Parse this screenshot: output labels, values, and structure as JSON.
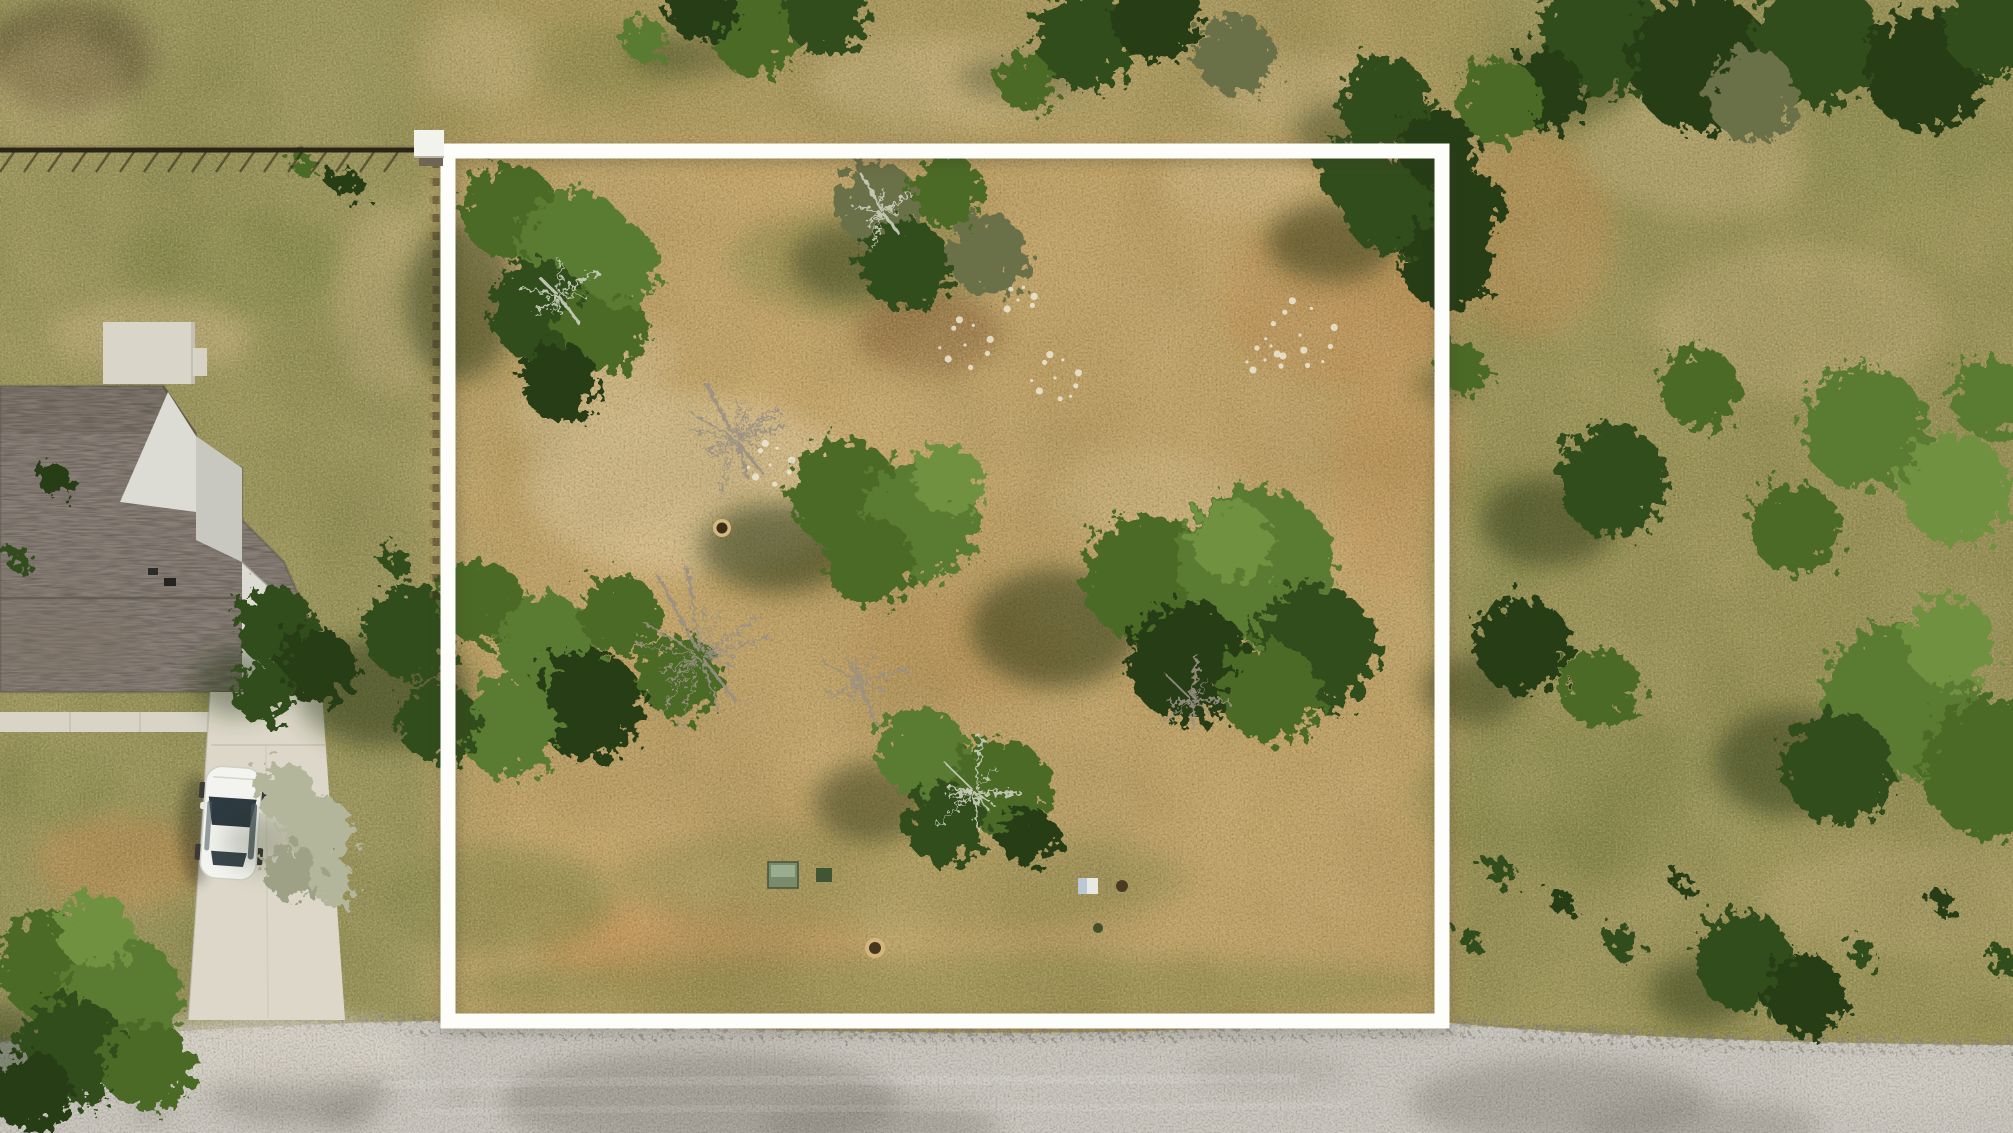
{
  "meta": {
    "kind": "aerial-drone-photo",
    "subject": "vacant residential lot outlined with a white property boundary, house with driveway and car at left, road along bottom",
    "width": 2013,
    "height": 1133
  },
  "colors": {
    "base": "#b09a5f",
    "zone_left": "#8e9055",
    "zone_right": "#8c8d50",
    "zone_top": "#a89759",
    "zone_lot": "#c9a667",
    "road": "#c9c6c0",
    "gravel": "#8a8375",
    "stain_dark": "#827e76",
    "stain_light": "#dad6cc",
    "driveway": "#dcd7c8",
    "sidewalk": "#d8d4c6",
    "patio": "#d9d5c9",
    "roof": "#8a8178",
    "roof_dark": "#7e756c",
    "wall": "#c8c8c1",
    "wall_lit": "#dcdcd4",
    "car": "#f3f3ef",
    "glass": "#2e3a42",
    "glass2": "#39454d",
    "dish": "#eaeae5",
    "fence": "#2b2516",
    "boundary": "#fdfdfa",
    "shadow": "#1f2e11",
    "tm": "#4c6b28",
    "tm2": "#5a7c31",
    "td": "#334d1c",
    "td2": "#273d15",
    "tl": "#6f9240",
    "to": "#6b6f46",
    "dry": "#b4b69c",
    "dry2": "#9fa187",
    "branch": "#9b9184",
    "branch_light": "#ccd0bf",
    "rock": "#ece7d6",
    "dirt_sand": "#d9bf8e",
    "dirt_orange": "#c28b4e",
    "dirt_brown": "#8a5f35",
    "grass_green": "#798140",
    "scrub": "#5d5330",
    "mottle_dark": "#6b6b3a",
    "mottle_light": "#e8d19c",
    "box_green": "#7a8b6a",
    "box_green_top": "#9fb093",
    "box_dark_green": "#3f5534",
    "box_white": "#e8e9e2",
    "box_blue": "#b9c8d2"
  },
  "scene": {
    "boundary": {
      "x1": 448,
      "y1": 151,
      "x2": 1442,
      "y2": 1021,
      "stroke_width": 15,
      "post_cap": {
        "x": 414,
        "y": 130,
        "w": 30,
        "h": 27
      }
    },
    "fence": {
      "y": 150,
      "x_end": 417,
      "vertical_x": 434,
      "vertical_y2": 600
    },
    "road_top_y": 1028,
    "patches": [
      [
        70,
        55,
        85,
        55,
        "scrub",
        0.75
      ],
      [
        55,
        95,
        70,
        60,
        "dirt_sand",
        0.3
      ],
      [
        235,
        265,
        120,
        55,
        "grass_green",
        0.5
      ],
      [
        150,
        335,
        100,
        38,
        "dirt_sand",
        0.45
      ],
      [
        388,
        300,
        55,
        95,
        "dirt_sand",
        0.35
      ],
      [
        120,
        862,
        85,
        48,
        "dirt_orange",
        0.55
      ],
      [
        55,
        780,
        65,
        38,
        "grass_green",
        0.5
      ],
      [
        260,
        940,
        80,
        40,
        "grass_green",
        0.45
      ],
      [
        690,
        485,
        165,
        90,
        "dirt_sand",
        0.9
      ],
      [
        598,
        415,
        85,
        48,
        "dirt_sand",
        0.8
      ],
      [
        523,
        252,
        68,
        42,
        "dirt_sand",
        0.5
      ],
      [
        862,
        262,
        135,
        55,
        "grass_green",
        0.45
      ],
      [
        930,
        332,
        72,
        42,
        "dirt_brown",
        0.6
      ],
      [
        1338,
        300,
        115,
        85,
        "dirt_orange",
        0.55
      ],
      [
        1398,
        478,
        65,
        115,
        "dirt_orange",
        0.4
      ],
      [
        958,
        652,
        115,
        55,
        "dirt_orange",
        0.4
      ],
      [
        700,
        945,
        165,
        50,
        "dirt_orange",
        0.5
      ],
      [
        1148,
        500,
        95,
        48,
        "dirt_sand",
        0.5
      ],
      [
        900,
        880,
        290,
        55,
        "grass_green",
        0.35
      ],
      [
        943,
        988,
        495,
        35,
        "grass_green",
        0.5
      ],
      [
        500,
        900,
        115,
        55,
        "grass_green",
        0.5
      ],
      [
        1240,
        182,
        75,
        38,
        "dirt_sand",
        0.5
      ],
      [
        620,
        352,
        60,
        35,
        "dirt_sand",
        0.6
      ],
      [
        1528,
        232,
        85,
        105,
        "dirt_orange",
        0.5
      ],
      [
        1700,
        152,
        115,
        65,
        "dirt_sand",
        0.4
      ],
      [
        1800,
        322,
        145,
        75,
        "dirt_sand",
        0.35
      ],
      [
        1600,
        800,
        190,
        75,
        "grass_green",
        0.4
      ],
      [
        1905,
        900,
        145,
        55,
        "dirt_sand",
        0.3
      ],
      [
        1480,
        560,
        55,
        95,
        "grass_green",
        0.4
      ],
      [
        1900,
        150,
        110,
        60,
        "grass_green",
        0.35
      ],
      [
        950,
        82,
        140,
        45,
        "dirt_sand",
        0.5
      ],
      [
        605,
        60,
        95,
        38,
        "grass_green",
        0.4
      ],
      [
        1300,
        92,
        95,
        38,
        "dirt_sand",
        0.45
      ],
      [
        480,
        60,
        60,
        50,
        "dirt_sand",
        0.4
      ]
    ],
    "stains": [
      [
        300,
        1090,
        90,
        36,
        0.45,
        0
      ],
      [
        700,
        1102,
        200,
        52,
        0.5,
        0
      ],
      [
        880,
        1128,
        120,
        28,
        0.45,
        0
      ],
      [
        1560,
        1102,
        150,
        42,
        0.45,
        0
      ],
      [
        1270,
        1070,
        80,
        22,
        0.2,
        0
      ],
      [
        150,
        1112,
        14,
        9,
        0.6,
        0
      ],
      [
        345,
        1114,
        26,
        12,
        0.5,
        0
      ],
      [
        460,
        1097,
        18,
        8,
        0.3,
        0
      ],
      [
        1700,
        1128,
        120,
        28,
        0.4,
        0
      ],
      [
        268,
        1052,
        150,
        36,
        0.8,
        1
      ],
      [
        1900,
        1080,
        110,
        30,
        0.35,
        1
      ]
    ],
    "trees": [
      {
        "b": [
          [
            510,
            212,
            48,
            "tm"
          ],
          [
            575,
            245,
            55,
            "tm2"
          ],
          [
            540,
            312,
            50,
            "td"
          ],
          [
            602,
            330,
            45,
            "tm"
          ],
          [
            560,
            382,
            38,
            "td2"
          ],
          [
            620,
            265,
            40,
            "tm2"
          ]
        ],
        "s": [
          462,
          300,
          55,
          80,
          0.45
        ]
      },
      {
        "b": [
          [
            878,
            205,
            42,
            "to"
          ],
          [
            948,
            192,
            36,
            "tm"
          ],
          [
            988,
            255,
            40,
            "to"
          ],
          [
            905,
            265,
            45,
            "td"
          ]
        ],
        "s": [
          848,
          262,
          58,
          38,
          0.4
        ]
      },
      {
        "b": [
          [
            1392,
            205,
            50,
            "td"
          ],
          [
            1447,
            265,
            45,
            "td2"
          ],
          [
            1352,
            172,
            35,
            "td"
          ],
          [
            1470,
            205,
            35,
            "td2"
          ]
        ],
        "s": [
          1332,
          242,
          65,
          40,
          0.45
        ]
      },
      {
        "b": [
          [
            845,
            495,
            55,
            "tm"
          ],
          [
            920,
            520,
            60,
            "tm2"
          ],
          [
            870,
            562,
            45,
            "tm"
          ],
          [
            948,
            480,
            35,
            "tl"
          ]
        ],
        "s": [
          778,
          548,
          78,
          45,
          0.5
        ]
      },
      {
        "b": [
          [
            1148,
            578,
            65,
            "tm"
          ],
          [
            1255,
            565,
            78,
            "tm2"
          ],
          [
            1315,
            648,
            62,
            "td"
          ],
          [
            1188,
            662,
            60,
            "td2"
          ],
          [
            1270,
            692,
            50,
            "tm"
          ],
          [
            1232,
            540,
            40,
            "tl"
          ]
        ],
        "s": [
          1055,
          628,
          85,
          60,
          0.5
        ]
      },
      {
        "b": [
          [
            922,
            752,
            45,
            "tm2"
          ],
          [
            1000,
            788,
            50,
            "tm"
          ],
          [
            945,
            825,
            40,
            "td"
          ],
          [
            1028,
            838,
            30,
            "td2"
          ]
        ],
        "s": [
          872,
          802,
          58,
          40,
          0.45
        ]
      },
      {
        "b": [
          [
            412,
            632,
            48,
            "td"
          ],
          [
            482,
            602,
            42,
            "tm"
          ],
          [
            548,
            645,
            50,
            "tm2"
          ],
          [
            620,
            615,
            40,
            "tm"
          ],
          [
            588,
            705,
            55,
            "td2"
          ],
          [
            508,
            726,
            50,
            "tm2"
          ],
          [
            680,
            676,
            42,
            "tm"
          ],
          [
            438,
            722,
            40,
            "td"
          ]
        ],
        "s": [
          385,
          692,
          88,
          55,
          0.45
        ]
      },
      {
        "b": [
          [
            275,
            625,
            40,
            "td"
          ],
          [
            316,
            666,
            38,
            "td2"
          ],
          [
            262,
            692,
            30,
            "td"
          ]
        ],
        "s": [
          238,
          682,
          45,
          34,
          0.4
        ]
      },
      {
        "b": [
          [
            285,
            792,
            30,
            "dry"
          ],
          [
            318,
            832,
            36,
            "dry"
          ],
          [
            292,
            872,
            28,
            "dry2"
          ],
          [
            332,
            882,
            22,
            "dry"
          ]
        ],
        "s": [
          262,
          842,
          38,
          28,
          0.22
        ]
      },
      {
        "b": [
          [
            52,
            965,
            55,
            "tm"
          ],
          [
            122,
            996,
            60,
            "tm2"
          ],
          [
            72,
            1052,
            55,
            "td"
          ],
          [
            148,
            1066,
            45,
            "tm"
          ],
          [
            32,
            1092,
            40,
            "td2"
          ],
          [
            95,
            930,
            38,
            "tl"
          ]
        ],
        "s": [
          0,
          1052,
          58,
          48,
          0.4
        ]
      },
      {
        "b": [
          [
            1462,
            368,
            26,
            "tm"
          ]
        ],
        "s": [
          1442,
          385,
          28,
          18,
          0.3
        ]
      },
      {
        "b": [
          [
            1600,
            35,
            60,
            "td"
          ],
          [
            1700,
            62,
            70,
            "td2"
          ],
          [
            1815,
            42,
            65,
            "td"
          ],
          [
            1925,
            70,
            60,
            "td2"
          ],
          [
            1995,
            28,
            50,
            "td"
          ],
          [
            1752,
            95,
            45,
            "to"
          ],
          [
            1545,
            90,
            40,
            "td2"
          ]
        ],
        "s": [
          1560,
          85,
          75,
          35,
          0.3
        ]
      },
      {
        "b": [
          [
            1500,
            102,
            42,
            "tm"
          ],
          [
            1385,
            102,
            45,
            "td"
          ],
          [
            1438,
            148,
            38,
            "td2"
          ]
        ],
        "s": [
          1352,
          132,
          58,
          32,
          0.35
        ]
      },
      {
        "b": [
          [
            1612,
            480,
            55,
            "td"
          ],
          [
            1700,
            388,
            40,
            "tm"
          ],
          [
            1865,
            428,
            62,
            "tm2"
          ],
          [
            1955,
            488,
            55,
            "tl"
          ],
          [
            1795,
            528,
            45,
            "tm"
          ],
          [
            1990,
            398,
            40,
            "tm2"
          ]
        ],
        "s": [
          1548,
          522,
          68,
          45,
          0.45
        ]
      },
      {
        "b": [
          [
            1522,
            645,
            48,
            "td2"
          ],
          [
            1600,
            688,
            40,
            "tm"
          ]
        ],
        "s": [
          1472,
          690,
          52,
          34,
          0.4
        ]
      },
      {
        "b": [
          [
            1900,
            702,
            78,
            "tm2"
          ],
          [
            1992,
            768,
            70,
            "tm"
          ],
          [
            1838,
            768,
            55,
            "td"
          ],
          [
            1950,
            642,
            45,
            "tl"
          ]
        ],
        "s": [
          1792,
          762,
          78,
          55,
          0.45
        ]
      },
      {
        "b": [
          [
            1745,
            962,
            50,
            "td"
          ],
          [
            1806,
            996,
            40,
            "td2"
          ]
        ],
        "s": [
          1700,
          992,
          52,
          34,
          0.4
        ]
      },
      {
        "b": [
          [
            755,
            30,
            45,
            "tm"
          ],
          [
            825,
            14,
            40,
            "td"
          ],
          [
            700,
            5,
            35,
            "td2"
          ],
          [
            645,
            40,
            22,
            "tm2"
          ]
        ],
        "s": [
          690,
          55,
          65,
          22,
          0.3
        ]
      },
      {
        "b": [
          [
            1085,
            40,
            50,
            "td"
          ],
          [
            1155,
            15,
            45,
            "td2"
          ],
          [
            1235,
            55,
            40,
            "to"
          ],
          [
            1025,
            82,
            28,
            "tm"
          ]
        ],
        "s": [
          1022,
          78,
          65,
          22,
          0.3
        ]
      },
      {
        "b": [
          [
            1500,
            872,
            15,
            "td"
          ],
          [
            1562,
            902,
            12,
            "td2"
          ],
          [
            1622,
            942,
            16,
            "td"
          ],
          [
            1682,
            882,
            10,
            "td2"
          ],
          [
            1862,
            952,
            14,
            "td"
          ],
          [
            1942,
            902,
            12,
            "td2"
          ],
          [
            2002,
            962,
            15,
            "td"
          ],
          [
            1472,
            940,
            12,
            "td"
          ]
        ],
        "s": [
          0,
          0,
          0,
          0,
          0
        ]
      },
      {
        "b": [
          [
            345,
            182,
            15,
            "td2"
          ],
          [
            302,
            162,
            12,
            "tm"
          ],
          [
            398,
            562,
            14,
            "td"
          ],
          [
            55,
            480,
            16,
            "td2"
          ],
          [
            20,
            560,
            13,
            "td"
          ]
        ],
        "s": [
          0,
          0,
          0,
          0,
          0
        ]
      }
    ],
    "debris": [
      {
        "x": 735,
        "y": 438,
        "r": 62,
        "n": 14,
        "c": "branch"
      },
      {
        "x": 700,
        "y": 655,
        "r": 85,
        "n": 16,
        "c": "branch"
      },
      {
        "x": 860,
        "y": 682,
        "r": 50,
        "n": 10,
        "c": "branch"
      },
      {
        "x": 975,
        "y": 792,
        "r": 55,
        "n": 10,
        "c": "branch_light"
      },
      {
        "x": 1192,
        "y": 700,
        "r": 45,
        "n": 8,
        "c": "branch"
      },
      {
        "x": 882,
        "y": 212,
        "r": 40,
        "n": 8,
        "c": "branch_light"
      },
      {
        "x": 558,
        "y": 295,
        "r": 45,
        "n": 9,
        "c": "branch_light"
      }
    ],
    "rocks": [
      {
        "x": 1055,
        "y": 378,
        "s": 26,
        "n": 10
      },
      {
        "x": 965,
        "y": 345,
        "s": 28,
        "n": 9
      },
      {
        "x": 1300,
        "y": 335,
        "s": 38,
        "n": 12
      },
      {
        "x": 770,
        "y": 465,
        "s": 24,
        "n": 9
      },
      {
        "x": 1018,
        "y": 300,
        "s": 18,
        "n": 6
      },
      {
        "x": 1265,
        "y": 360,
        "s": 20,
        "n": 7
      }
    ]
  }
}
